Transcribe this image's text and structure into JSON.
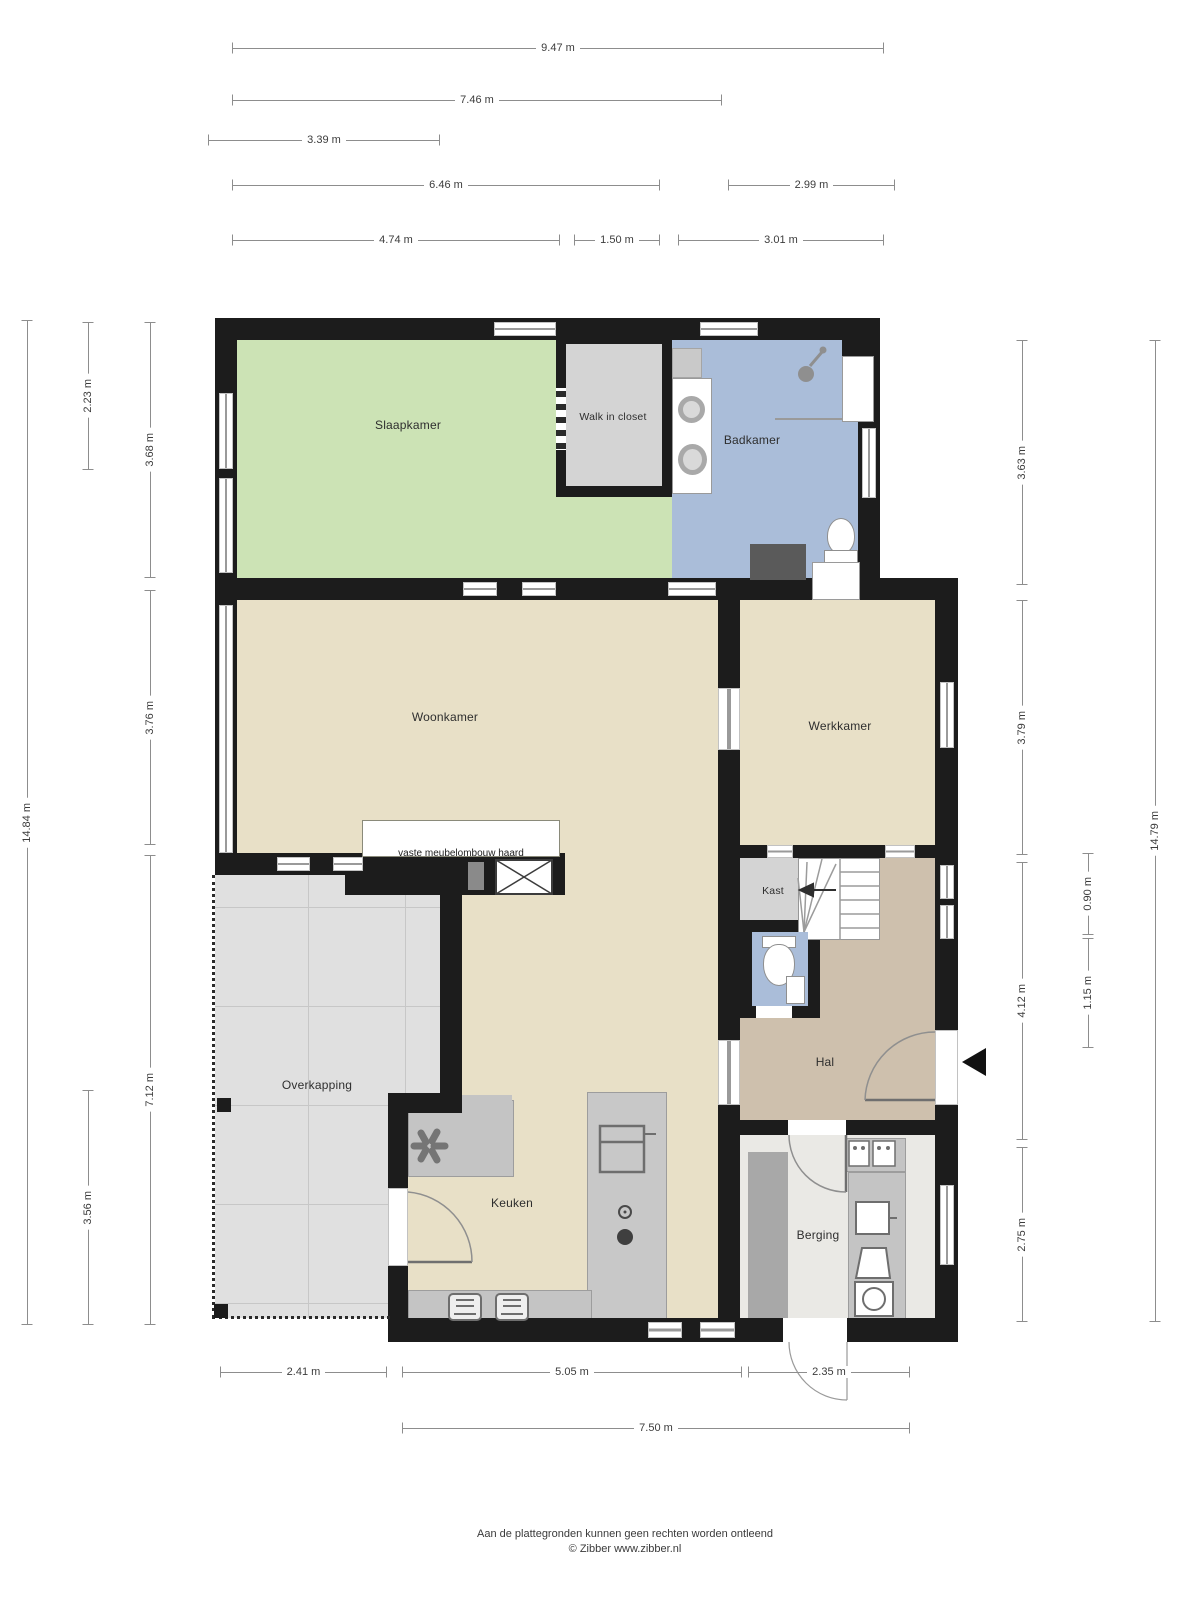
{
  "rooms": {
    "slaapkamer": "Slaapkamer",
    "walk_in_closet": "Walk in closet",
    "badkamer": "Badkamer",
    "woonkamer": "Woonkamer",
    "werkkamer": "Werkkamer",
    "kast": "Kast",
    "hal": "Hal",
    "overkapping": "Overkapping",
    "keuken": "Keuken",
    "berging": "Berging"
  },
  "annotations": {
    "fireplace": "vaste meubelombouw haard"
  },
  "dims": {
    "t_947": "9.47 m",
    "t_746": "7.46 m",
    "t_339": "3.39 m",
    "t_646": "6.46 m",
    "t_299": "2.99 m",
    "t_474": "4.74 m",
    "t_150": "1.50 m",
    "t_301": "3.01 m",
    "l_1484": "14.84 m",
    "l_223": "2.23 m",
    "l_356": "3.56 m",
    "l_368": "3.68 m",
    "l_376": "3.76 m",
    "l_712": "7.12 m",
    "r_363": "3.63 m",
    "r_379": "3.79 m",
    "r_412": "4.12 m",
    "r_275": "2.75 m",
    "r_090": "0.90 m",
    "r_115": "1.15 m",
    "r_1479": "14.79 m",
    "b_241": "2.41 m",
    "b_505": "5.05 m",
    "b_235": "2.35 m",
    "b_750": "7.50 m"
  },
  "footer": {
    "line1": "Aan de plattegronden kunnen geen rechten worden ontleend",
    "line2": "© Zibber www.zibber.nl"
  },
  "colors": {
    "wall": "#1c1c1c",
    "bedroom": "#cce3b5",
    "bath": "#aabdd9",
    "living": "#e8e0c7",
    "hall": "#cec0ad",
    "closet": "#d4d4d4",
    "tiles": "#e0e0e0",
    "tileline": "#c7c7c7",
    "storage": "#eae9e5",
    "wardrobe": "#a8a8a8",
    "counter": "#c4c4c4",
    "island": "#c8c8c8",
    "darkunit": "#5a5a5a"
  }
}
